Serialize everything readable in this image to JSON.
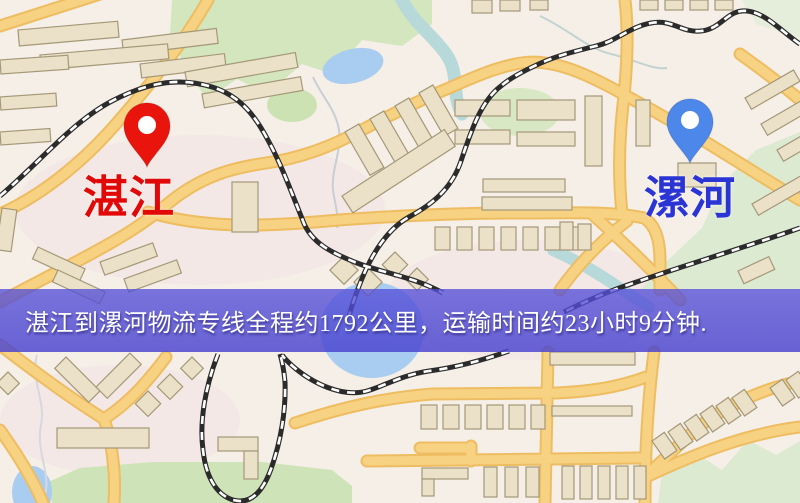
{
  "map": {
    "origin": {
      "label": "湛江",
      "pin_color": "#e9150d",
      "label_color": "#e10808"
    },
    "destination": {
      "label": "漯河",
      "pin_color": "#4d87ea",
      "label_color": "#2b35d6"
    },
    "banner": {
      "text": "湛江到漯河物流专线全程约1792公里，运输时间约23小时9分钟.",
      "distance": "约1792公里",
      "duration": "约23小时9分钟",
      "background": "#5650d4",
      "text_color": "#ffffff"
    },
    "legend_colors": {
      "background": "#f5efe8",
      "road": "#f7d282",
      "road_casing": "#eebd62",
      "building": "#eae1c8",
      "building_outline": "#a59878",
      "park_green": "#d3e6bd",
      "water_blue": "#a9cdf0",
      "railway": "#2b2b2b"
    }
  }
}
